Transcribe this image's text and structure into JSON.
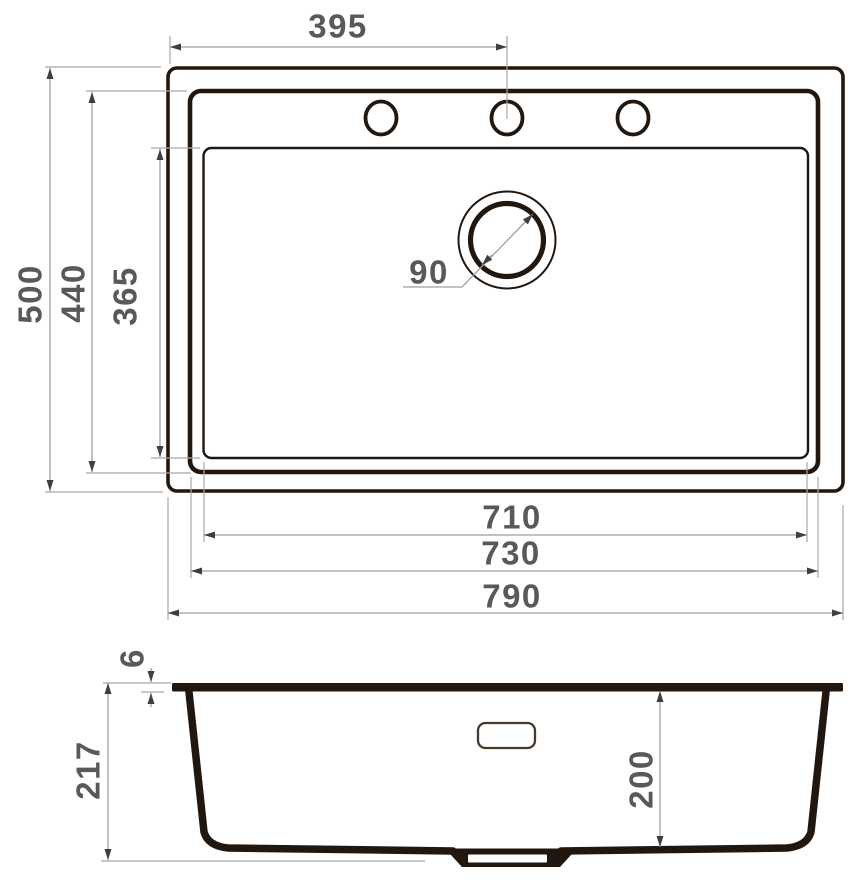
{
  "title": "Kitchen sink dimension drawing",
  "colors": {
    "background": "#ffffff",
    "drawing_ink": "#22170e",
    "dimension_line": "#9e9e9e",
    "arrow": "#3f3f3f",
    "label_text": "#58595b"
  },
  "top_view": {
    "faucet_offset": "395",
    "overall_depth": "500",
    "bowl_outer_depth": "440",
    "bowl_inner_depth": "365",
    "drain_diameter": "90",
    "bowl_inner_width": "710",
    "bowl_outer_width": "730",
    "overall_width": "790"
  },
  "section_view": {
    "rim_thickness": "6",
    "overall_height": "217",
    "bowl_depth": "200"
  }
}
